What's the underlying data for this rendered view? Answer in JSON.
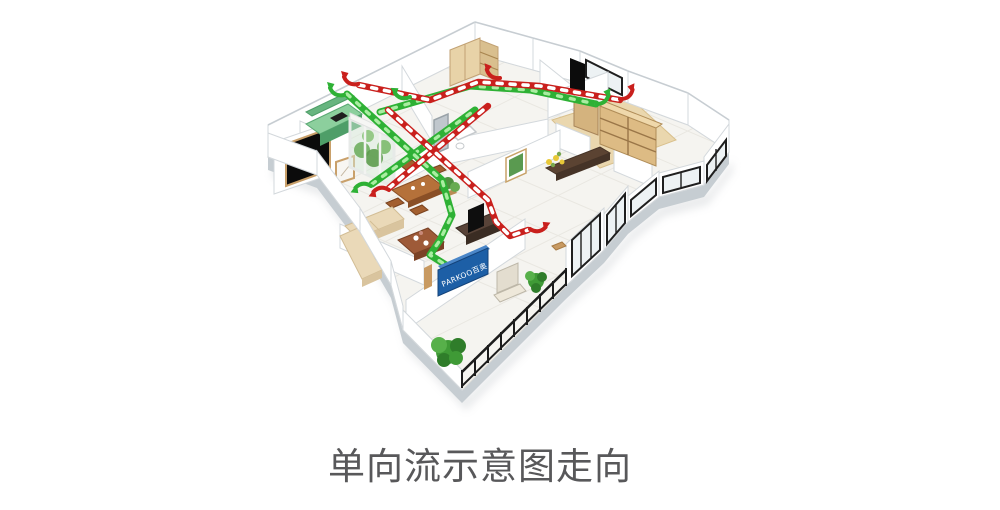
{
  "caption": {
    "text": "单向流示意图走向"
  },
  "logo": {
    "text": "PARKOO百奥"
  },
  "colors": {
    "fresh_air_green": "#2eb135",
    "fresh_air_light": "#a9eda1",
    "exhaust_red": "#c9201d",
    "exhaust_dash_white": "#ffffff",
    "logo_blue": "#1d5fa6",
    "caption_text": "#58585a"
  }
}
